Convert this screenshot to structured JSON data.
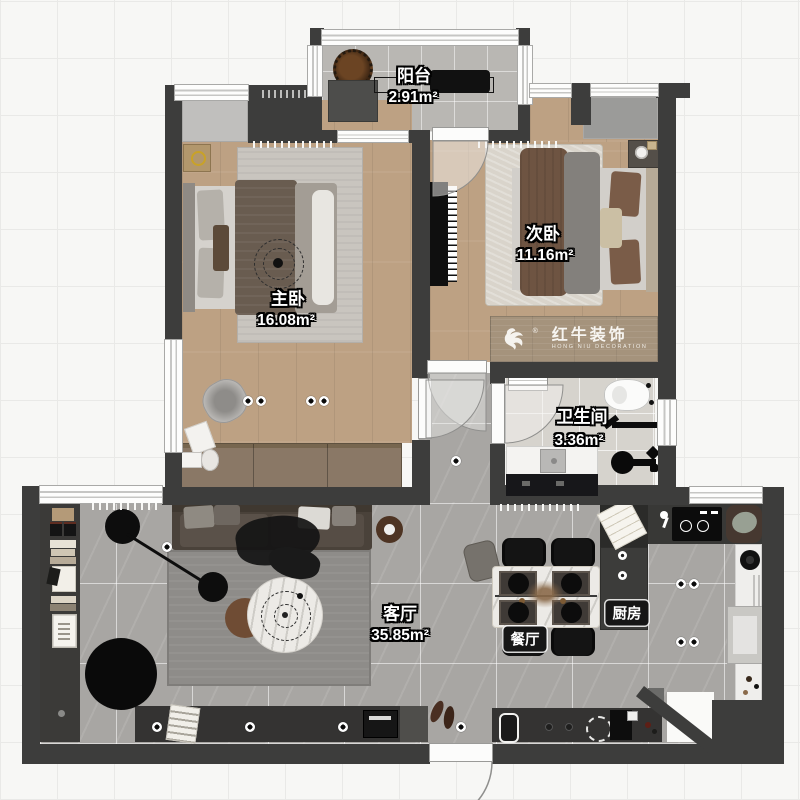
{
  "brand": {
    "cn": "红牛装饰",
    "en": "HONG NIU DECORATION",
    "reg": "®"
  },
  "rooms": {
    "balcony": {
      "name": "阳台",
      "area": "2.91m²"
    },
    "master": {
      "name": "主卧",
      "area": "16.08m²"
    },
    "secondary": {
      "name": "次卧",
      "area": "11.16m²"
    },
    "bathroom": {
      "name": "卫生间",
      "area": "3.36m²"
    },
    "living": {
      "name": "客厅",
      "area": "35.85m²"
    },
    "dining": {
      "name": "餐厅"
    },
    "kitchen": {
      "name": "厨房"
    }
  },
  "colors": {
    "wall": "#3d3d3c",
    "wood_floor": "#bda183",
    "gray_tile": "#a8a6a3",
    "bath_tile": "#d6d3cd",
    "balcony_tile": "#b9b7b3",
    "logo_board": "#a5937c"
  }
}
